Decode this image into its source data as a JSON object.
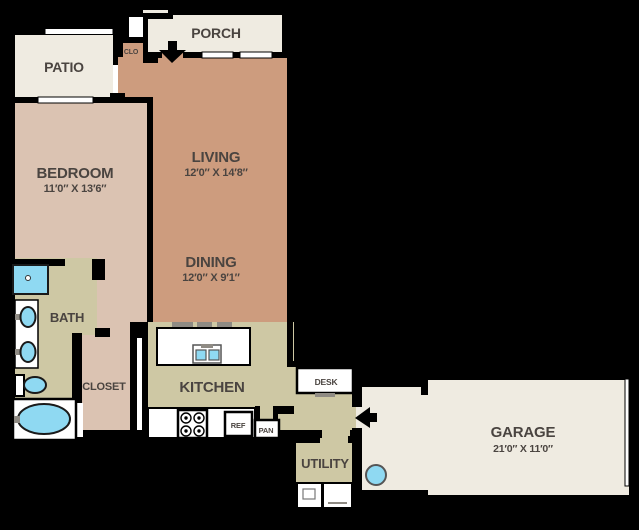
{
  "floorplan": {
    "rooms": {
      "patio": "PATIO",
      "porch": "PORCH",
      "clo": "CLO",
      "living": "LIVING",
      "living_dims": "12′0″ X 14′8″",
      "dining": "DINING",
      "dining_dims": "12′0″ X 9′1″",
      "bedroom": "BEDROOM",
      "bedroom_dims": "11′0″ X 13′6″",
      "bath": "BATH",
      "closet": "CLOSET",
      "kitchen": "KITCHEN",
      "desk": "DESK",
      "ref": "REF",
      "pan": "PAN",
      "utility": "UTILITY",
      "garage": "GARAGE",
      "garage_dims": "21′0″ X 11′0″"
    },
    "palette": {
      "background": "#000000",
      "outdoor_cream": "#EFEBE1",
      "bedroom_tan": "#DBC3B2",
      "living_tan": "#CD9C7E",
      "kitchen_khaki": "#CEC8A4",
      "fixture_blue": "#8FD9F2",
      "label_gray": "#4A4440",
      "wall_black": "#000000"
    },
    "icons": [
      "entry-door-arrow",
      "garage-entry-arrow",
      "shower",
      "vanity-sinks",
      "toilet",
      "bathtub",
      "kitchen-sink",
      "stove-burners",
      "refrigerator",
      "pantry",
      "washer-dryer",
      "water-heater",
      "desk-chair",
      "breakfast-bar-stools",
      "garage-door",
      "window",
      "patio-door"
    ]
  }
}
